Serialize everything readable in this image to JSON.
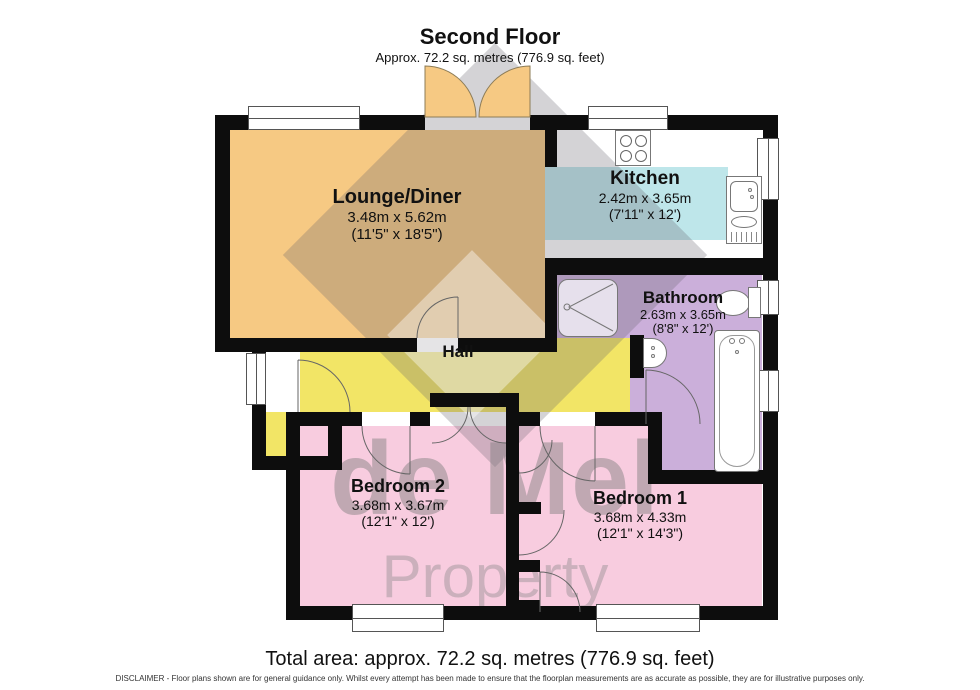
{
  "title": {
    "heading": "Second Floor",
    "subheading": "Approx. 72.2 sq. metres (776.9 sq. feet)"
  },
  "rooms": {
    "lounge": {
      "name": "Lounge/Diner",
      "metric": "3.48m x 5.62m",
      "imperial": "(11'5\" x 18'5\")"
    },
    "kitchen": {
      "name": "Kitchen",
      "metric": "2.42m x 3.65m",
      "imperial": "(7'11\" x 12')"
    },
    "bathroom": {
      "name": "Bathroom",
      "metric": "2.63m x 3.65m",
      "imperial": "(8'8\" x 12')"
    },
    "hall": {
      "name": "Hall"
    },
    "bedroom2": {
      "name": "Bedroom 2",
      "metric": "3.68m x 3.67m",
      "imperial": "(12'1\" x 12')"
    },
    "bedroom1": {
      "name": "Bedroom 1",
      "metric": "3.68m x 4.33m",
      "imperial": "(12'1\" x 14'3\")"
    }
  },
  "watermark": {
    "line1": "de Mel",
    "line2": "Property"
  },
  "footer": {
    "total_area": "Total area: approx. 72.2 sq. metres (776.9 sq. feet)",
    "disclaimer": "DISCLAIMER -  Floor plans shown are for general guidance only. Whilst every attempt has been made to ensure that the floorplan measurements are as accurate as possible, they are for illustrative purposes only."
  },
  "colors": {
    "lounge": "#F6C983",
    "kitchen": "#BEE6EA",
    "bathroom": "#CBAFDA",
    "hall": "#F2E566",
    "bedroom": "#F8CCDF",
    "wall": "#0D0D0D"
  }
}
